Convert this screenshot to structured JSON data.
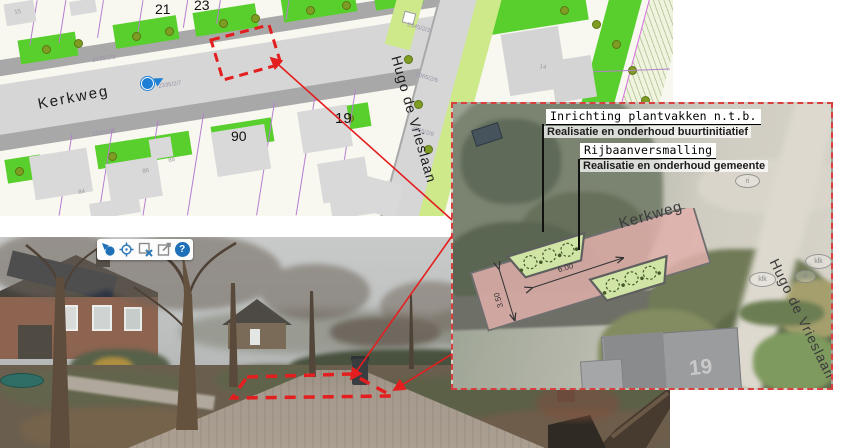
{
  "map": {
    "street_kerkweg": "Kerkweg",
    "street_hugo": "Hugo de Vrieslaan",
    "houses": {
      "n21": "21",
      "n23": "23",
      "n90": "90",
      "n19": "19",
      "n14": "14",
      "n15": "15",
      "n84": "84",
      "n86": "86",
      "n88": "88"
    },
    "parcels": {
      "p1": "2335/2/2",
      "p2": "2335/2/7",
      "p3": "2335/2/3",
      "p4": "2345/2/3",
      "p5": "2065/2/6",
      "p6": "2065/2/8"
    }
  },
  "panel": {
    "callout1_title": "Inrichting plantvakken n.t.b.",
    "callout1_sub": "Realisatie en onderhoud buurtinitiatief",
    "callout2_title": "Rijbaanversmalling",
    "callout2_sub": "Realisatie en onderhoud gemeente",
    "street_kerkweg": "Kerkweg",
    "street_hugo": "Hugo de Vrieslaan",
    "house_number": "19",
    "dim_length": "6.00",
    "dim_width": "3.50",
    "symbols": {
      "s1": "ri",
      "s2": "klk",
      "s3": "klk",
      "s4": "ri"
    }
  },
  "photo": {
    "toolbar": {
      "help_label": "?"
    }
  },
  "colors": {
    "highlight_red": "#e41e1e",
    "map_green": "#59cf2d",
    "map_light_green": "#cde98a",
    "plan_pink": "#e2b0ac",
    "plan_bed_green": "#cfe4a5",
    "toolbar_blue": "#1d6fb8"
  }
}
